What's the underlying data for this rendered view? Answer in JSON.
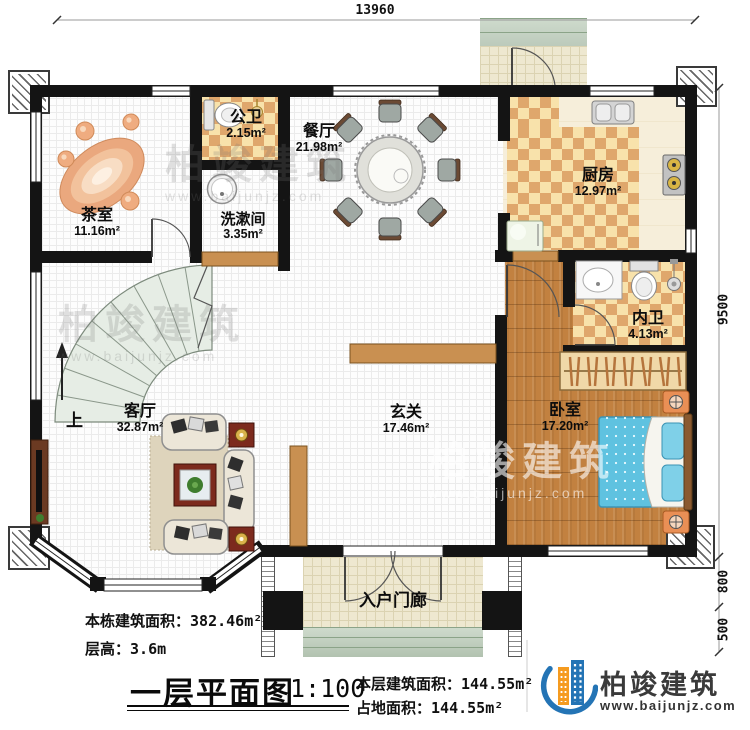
{
  "dimensions": {
    "top_width": "13960",
    "right_main": "9500",
    "right_porch": "800",
    "right_steps": "500"
  },
  "rooms": {
    "tea_room": {
      "name": "茶室",
      "area": "11.16m²"
    },
    "public_bath": {
      "name": "公卫",
      "area": "2.15m²"
    },
    "washroom": {
      "name": "洗漱间",
      "area": "3.35m²"
    },
    "dining_room": {
      "name": "餐厅",
      "area": "21.98m²"
    },
    "kitchen": {
      "name": "厨房",
      "area": "12.97m²"
    },
    "inner_bath": {
      "name": "内卫",
      "area": "4.13m²"
    },
    "living_room": {
      "name": "客厅",
      "area": "32.87m²"
    },
    "foyer": {
      "name": "玄关",
      "area": "17.46m²"
    },
    "bedroom": {
      "name": "卧室",
      "area": "17.20m²"
    },
    "entry_porch": {
      "name": "入户门廊"
    }
  },
  "stairs": {
    "up_label": "上"
  },
  "notes": {
    "building_total_label": "本栋建筑面积：",
    "building_total_value": "382.46m²",
    "floor_height_label": "层高：",
    "floor_height_value": "3.6m",
    "floor_area_label": "本层建筑面积：",
    "floor_area_value": "144.55m²",
    "footprint_label": "占地面积：",
    "footprint_value": "144.55m²"
  },
  "titleblock": {
    "title": "一层平面图",
    "scale": "1:100"
  },
  "brand": {
    "company": "柏竣建筑",
    "website": "www.baijunjz.com"
  },
  "colors": {
    "wall": "#141414",
    "tile_dark": "#dfa76c",
    "tile_light": "#f8e2ab",
    "wood": "#c28140",
    "stair": "#e6ede5",
    "bed_blue": "#5fc2e0",
    "brand_blue": "#2474b5",
    "brand_orange": "#f59b20"
  }
}
